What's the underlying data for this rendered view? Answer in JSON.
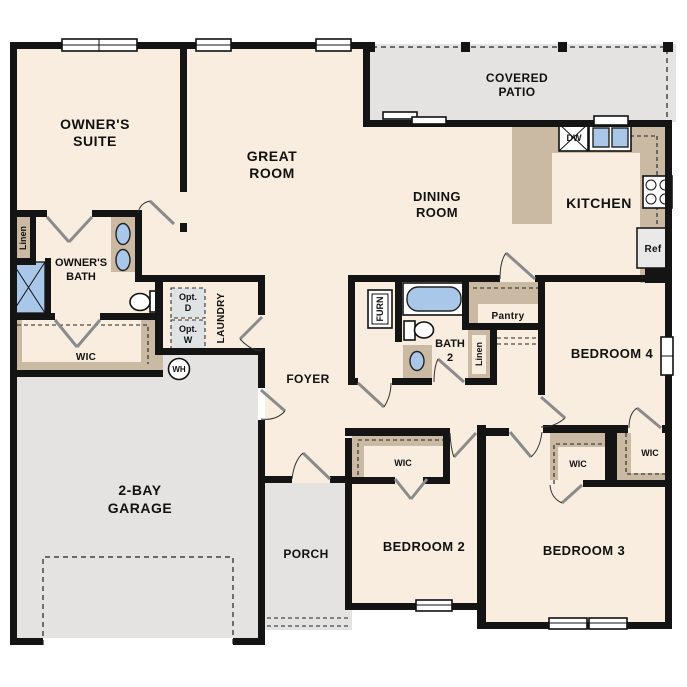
{
  "plan": {
    "type": "single-story floor plan",
    "colors": {
      "floor": "#f8edde",
      "outdoor": "#e4e3e1",
      "counter": "#cbbaa3",
      "fixture": "#a9c7e9",
      "appliance": "#e9e9e9",
      "opt_box": "#dfe3e4",
      "wall": "#141414"
    },
    "labels": {
      "owners_suite_l1": "OWNER'S",
      "owners_suite_l2": "SUITE",
      "great_room_l1": "GREAT",
      "great_room_l2": "ROOM",
      "covered_patio_l1": "COVERED",
      "covered_patio_l2": "PATIO",
      "dining_room_l1": "DINING",
      "dining_room_l2": "ROOM",
      "kitchen": "KITCHEN",
      "owners_bath_l1": "OWNER'S",
      "owners_bath_l2": "BATH",
      "bath2_l1": "BATH",
      "bath2_l2": "2",
      "foyer": "FOYER",
      "bedroom2": "BEDROOM 2",
      "bedroom3": "BEDROOM 3",
      "bedroom4": "BEDROOM 4",
      "garage_l1": "2-BAY",
      "garage_l2": "GARAGE",
      "porch": "PORCH",
      "laundry": "LAUNDRY",
      "wic_owner": "WIC",
      "wic_bed2": "WIC",
      "wic_bed3": "WIC",
      "wic_bed4": "WIC",
      "linen_owner": "Linen",
      "linen_hall": "Linen",
      "pantry": "Pantry",
      "opt_d_l1": "Opt.",
      "opt_d_l2": "D",
      "opt_w_l1": "Opt.",
      "opt_w_l2": "W",
      "wh": "WH",
      "furn": "FURN",
      "dw": "DW",
      "ref": "Ref"
    }
  }
}
